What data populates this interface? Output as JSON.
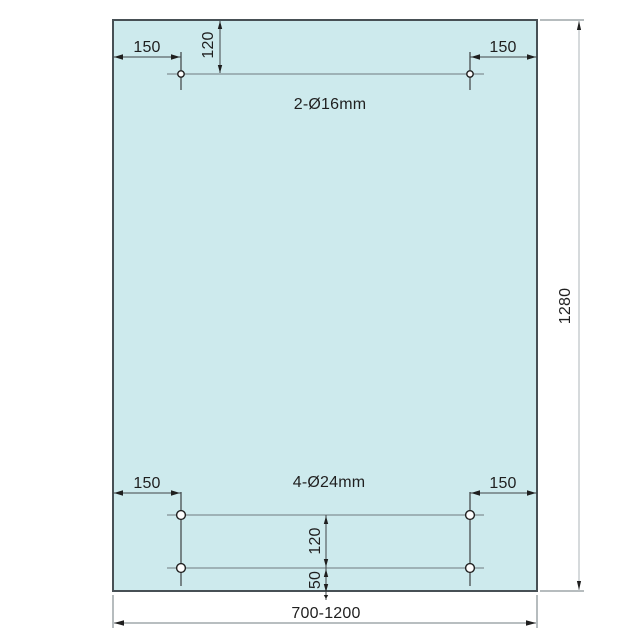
{
  "drawing": {
    "type": "technical-dimension-drawing",
    "subject": "rectangular glass panel with drilled holes",
    "panel": {
      "width_label": "700-1200",
      "height_label": "1280"
    },
    "top_holes": {
      "label": "2-Ø16mm",
      "count": 2,
      "diameter_mm": 16,
      "left_offset": "150",
      "right_offset": "150",
      "top_offset": "120"
    },
    "bottom_holes": {
      "label": "4-Ø24mm",
      "count": 4,
      "diameter_mm": 24,
      "left_offset": "150",
      "right_offset": "150",
      "row_spacing": "120",
      "bottom_offset": "50"
    },
    "colors": {
      "panel_fill": "#cdeaed",
      "panel_border": "#475055",
      "centerline_gray": "#8fa0a4",
      "line_dark": "#1f1f1f",
      "dim_line_dark": "#3f4448",
      "dim_line_mid": "#8e989b",
      "dim_line_light": "#bac1c4",
      "extension_line": "#6e797d",
      "text": "#1f1f1f"
    }
  }
}
